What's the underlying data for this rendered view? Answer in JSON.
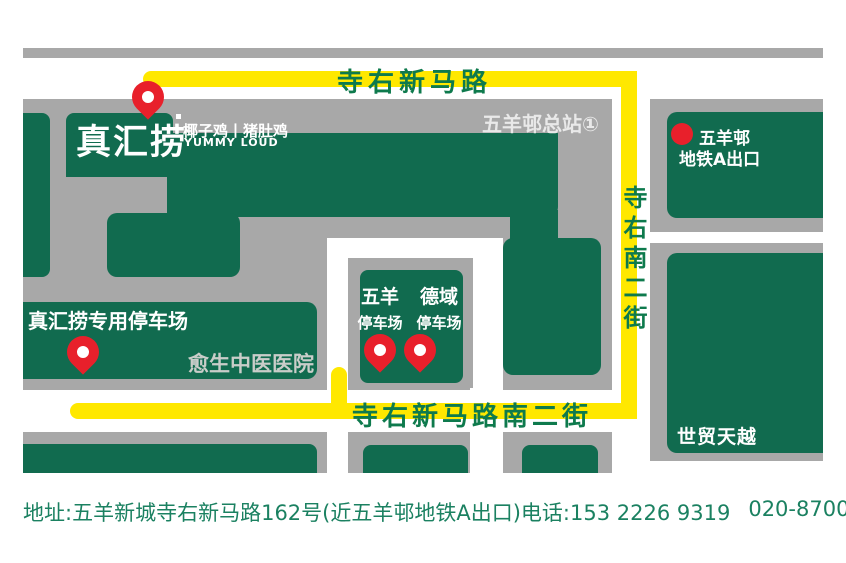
{
  "theme": {
    "map_gray": "#A8A8A8",
    "block_green": "#116B4F",
    "road_text_green": "#0E7A4D",
    "caption_green": "#1B8161",
    "route_yellow": "#FFE800",
    "pin_red": "#E8202B",
    "muted_text": "#C9CDC9",
    "station_text": "#E9E9E9",
    "pure_white": "#FFFFFF"
  },
  "logo": {
    "name": "真汇捞",
    "tagline": "椰子鸡丨猪肚鸡",
    "latin": "YUMMY LOUD"
  },
  "roads": {
    "top": "寺右新马路",
    "right_vertical": "寺右南二街",
    "bottom": "寺右新马路南二街"
  },
  "labels": {
    "bus_terminus": "五羊邨总站①",
    "metro_line1": "五羊邨",
    "metro_line2": "地铁A出口",
    "own_parking": "真汇捞专用停车场",
    "hospital": "愈生中医医院",
    "parking1_name": "五羊",
    "parking1_sub": "停车场",
    "parking2_name": "德域",
    "parking2_sub": "停车场",
    "mall": "世贸天越"
  },
  "caption": {
    "address_label": "地址:",
    "address": "五羊新城寺右新马路162号(近五羊邨地铁A出口)",
    "phone_label": "电话:",
    "phone1": "153 2226 9319",
    "phone2": "020-8700 6219"
  }
}
